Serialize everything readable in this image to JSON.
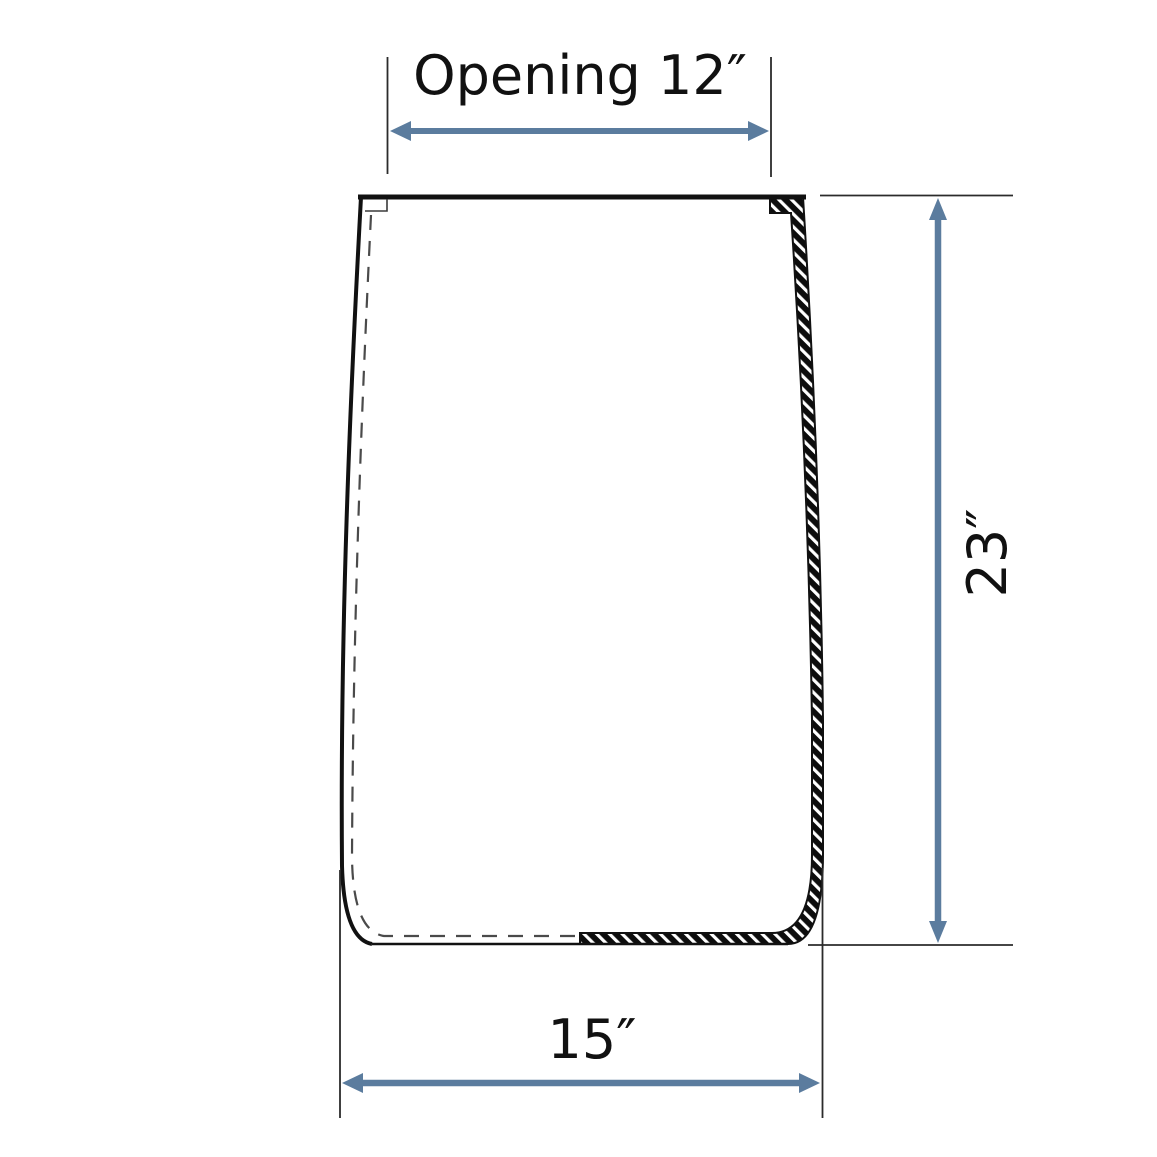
{
  "figure": {
    "type": "technical-diagram",
    "subject": "vessel cross-section with dimension callouts"
  },
  "colors": {
    "arrow": "#5b7c9e",
    "outline": "#111111",
    "extension_line": "#2b2b2b",
    "text": "#111111",
    "background": "#ffffff"
  },
  "dimensions": [
    {
      "id": "opening-width",
      "label": "Opening 12″",
      "value": 12,
      "unit": "inch",
      "position": "top",
      "orientation": "horizontal"
    },
    {
      "id": "height",
      "label": "23″",
      "value": 23,
      "unit": "inch",
      "position": "right",
      "orientation": "vertical"
    },
    {
      "id": "bottom-width",
      "label": "15″",
      "value": 15,
      "unit": "inch",
      "position": "bottom",
      "orientation": "horizontal"
    }
  ]
}
